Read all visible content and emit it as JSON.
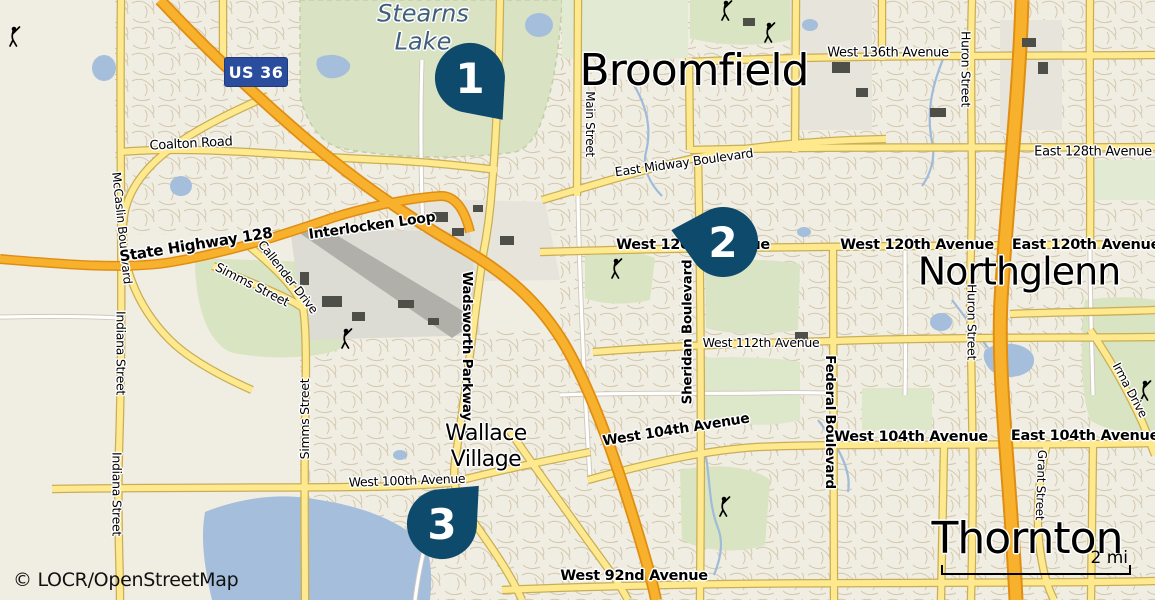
{
  "map": {
    "attribution": "© LOCR/OpenStreetMap",
    "scale_label": "2 mi",
    "shield_label": "US 36",
    "cities": {
      "stearns_lake": "Stearns\nLake",
      "broomfield": "Broomfield",
      "northglenn": "Northglenn",
      "thornton": "Thornton",
      "wallace_village": "Wallace\nVillage"
    },
    "markers": [
      {
        "number": "1"
      },
      {
        "number": "2"
      },
      {
        "number": "3"
      }
    ],
    "roads": {
      "coalton": "Coalton Road",
      "mccaslin": "McCaslin Boulevard",
      "sh128": "State Highway 128",
      "interlocken": "Interlocken Loop",
      "callender": "Callender Drive",
      "simms_upper": "Simms Street",
      "simms_lower": "Simms Street",
      "indiana_upper": "Indiana Street",
      "indiana_lower": "Indiana Street",
      "wadsworth": "Wadsworth Parkway",
      "main": "Main Street",
      "midway": "East Midway Boulevard",
      "w136": "West 136th Avenue",
      "e128": "East 128th Avenue",
      "w120_left": "West 120th Avenue",
      "w120_right": "West 120th Avenue",
      "e120": "East 120th Avenue",
      "w112": "West 112th Avenue",
      "sheridan": "Sheridan Boulevard",
      "federal": "Federal Boulevard",
      "w104_angled": "West 104th Avenue",
      "w104_mid": "West 104th Avenue",
      "e104": "East 104th Avenue",
      "w100": "West 100th Avenue",
      "w92": "West 92nd Avenue",
      "huron_top": "Huron Street",
      "huron_mid": "Huron Street",
      "grant": "Grant Street",
      "irma": "Irma Drive"
    },
    "colors": {
      "marker": "#0d4a6b",
      "shield_bg": "#2a4d9d",
      "highway_orange": "#f8b12c",
      "road_yellow": "#ffe98e",
      "water": "#a5bedb",
      "greenspace": "#d9e3c4",
      "background": "#f0ede2"
    }
  }
}
